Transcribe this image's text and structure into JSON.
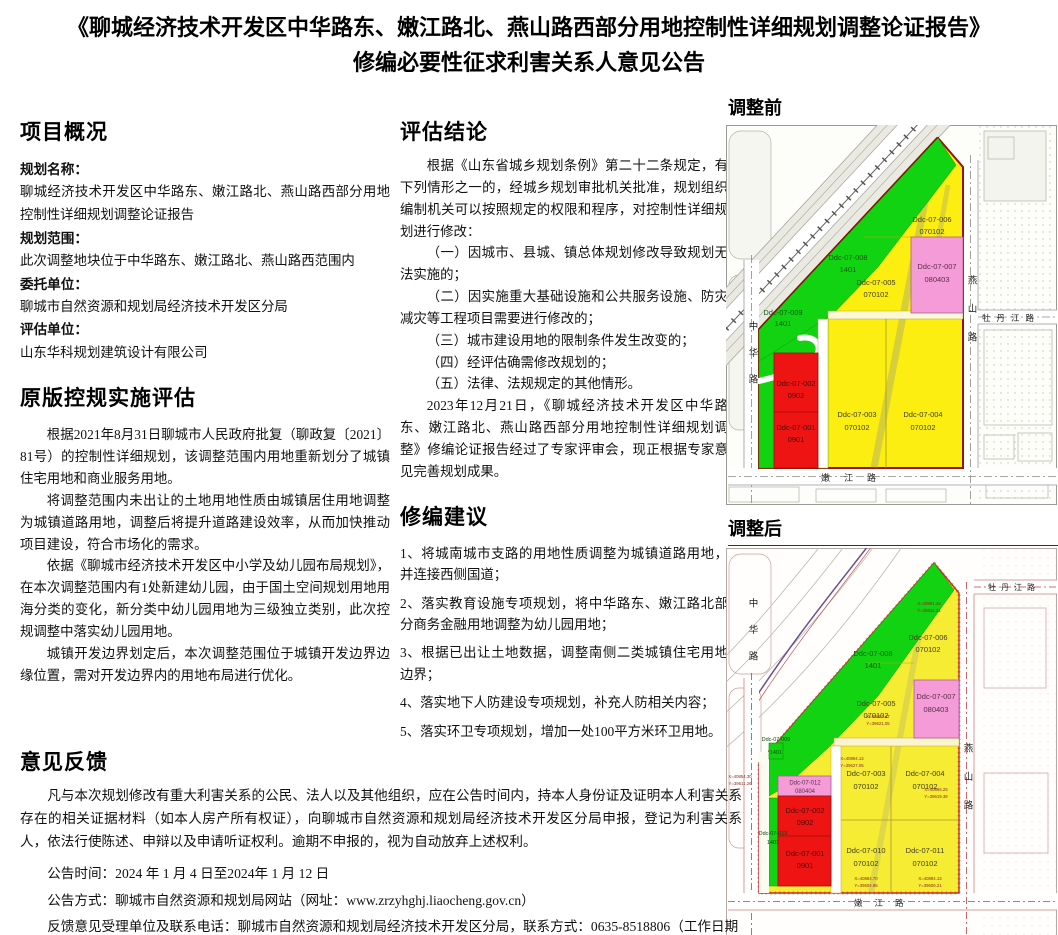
{
  "title": {
    "line1": "《聊城经济技术开发区中华路东、嫩江路北、燕山路西部分用地控制性详细规划调整论证报告》",
    "line2": "修编必要性征求利害关系人意见公告"
  },
  "project_overview": {
    "heading": "项目概况",
    "fields": [
      {
        "label": "规划名称：",
        "value": "聊城经济技术开发区中华路东、嫩江路北、燕山路西部分用地控制性详细规划调整论证报告"
      },
      {
        "label": "规划范围：",
        "value": "此次调整地块位于中华路东、嫩江路北、燕山路西范围内"
      },
      {
        "label": "委托单位：",
        "value": "聊城市自然资源和规划局经济技术开发区分局"
      },
      {
        "label": "评估单位：",
        "value": "山东华科规划建筑设计有限公司"
      }
    ]
  },
  "original_assessment": {
    "heading": "原版控规实施评估",
    "paragraphs": [
      "根据2021年8月31日聊城市人民政府批复（聊政复〔2021〕81号）的控制性详细规划，该调整范围内用地重新划分了城镇住宅用地和商业服务用地。",
      "将调整范围内未出让的土地用地性质由城镇居住用地调整为城镇道路用地，调整后将提升道路建设效率，从而加快推动项目建设，符合市场化的需求。",
      "依据《聊城市经济技术开发区中小学及幼儿园布局规划》，在本次调整范围内有1处新建幼儿园，由于国土空间规划用地用海分类的变化，新分类中幼儿园用地为三级独立类别，此次控规调整中落实幼儿园用地。",
      "城镇开发边界划定后，本次调整范围位于城镇开发边界边缘位置，需对开发边界内的用地布局进行优化。"
    ]
  },
  "conclusion": {
    "heading": "评估结论",
    "paragraphs": [
      "根据《山东省城乡规划条例》第二十二条规定，有下列情形之一的，经城乡规划审批机关批准，规划组织编制机关可以按照规定的权限和程序，对控制性详细规划进行修改：",
      "（一）因城市、县城、镇总体规划修改导致规划无法实施的；",
      "（二）因实施重大基础设施和公共服务设施、防灾减灾等工程项目需要进行修改的；",
      "（三）城市建设用地的限制条件发生改变的；",
      "（四）经评估确需修改规划的；",
      "（五）法律、法规规定的其他情形。",
      "2023年12月21日，《聊城经济技术开发区中华路东、嫩江路北、燕山路西部分用地控制性详细规划调整》修编论证报告经过了专家评审会，现正根据专家意见完善规划成果。"
    ]
  },
  "suggestions": {
    "heading": "修编建议",
    "items": [
      "1、将城南城市支路的用地性质调整为城镇道路用地，并连接西侧国道；",
      "2、落实教育设施专项规划，将中华路东、嫩江路北部分商务金融用地调整为幼儿园用地；",
      "3、根据已出让土地数据，调整南侧二类城镇住宅用地边界；",
      "4、落实地下人防建设专项规划，补充人防相关内容；",
      "5、落实环卫专项规划，增加一处100平方米环卫用地。"
    ]
  },
  "feedback": {
    "heading": "意见反馈",
    "paragraph": "凡与本次规划修改有重大利害关系的公民、法人以及其他组织，应在公告时间内，持本人身份证及证明本人利害关系存在的相关证据材料（如本人房产所有权证），向聊城市自然资源和规划局经济技术开发区分局申报，登记为利害关系人，依法行使陈述、申辩以及申请听证权利。逾期不申报的，视为自动放弃上述权利。",
    "lines": [
      "公告时间：2024 年  1  月  4  日至2024年  1  月  12  日",
      "公告方式：聊城市自然资源和规划局网站（网址：www.zrzyhghj.liaocheng.gov.cn）",
      "反馈意见受理单位及联系电话：聊城市自然资源和规划局经济技术开发区分局，联系方式：0635-8518806（工作日期间）"
    ]
  },
  "maps": {
    "roads": {
      "zhonghua": "中华路",
      "mudanjiang": "牡丹江路",
      "yanshan": "燕山路",
      "nenjiang": "嫩江路"
    },
    "legend_colors": {
      "residential_yellow": "#f6ec2a",
      "park_green": "#12d312",
      "commercial_red": "#ee1414",
      "business_pink": "#f49bd8"
    },
    "before": {
      "label": "调整前",
      "parcels": [
        {
          "code": "Ddc-07-006",
          "use": "070102"
        },
        {
          "code": "Ddc-07-008",
          "use": "1401"
        },
        {
          "code": "Ddc-07-005",
          "use": "070102"
        },
        {
          "code": "Ddc-07-007",
          "use": "080403"
        },
        {
          "code": "Ddc-07-009",
          "use": "1401"
        },
        {
          "code": "Ddc-07-002",
          "use": "0902"
        },
        {
          "code": "Ddc-07-001",
          "use": "0901"
        },
        {
          "code": "Ddc-07-003",
          "use": "070102"
        },
        {
          "code": "Ddc-07-004",
          "use": "070102"
        }
      ]
    },
    "after": {
      "label": "调整后",
      "parcels": [
        {
          "code": "Ddc-07-006",
          "use": "070102"
        },
        {
          "code": "Ddc-07-008",
          "use": "1401"
        },
        {
          "code": "Ddc-07-005",
          "use": "070102"
        },
        {
          "code": "Ddc-07-007",
          "use": "080403"
        },
        {
          "code": "Ddc-07-009",
          "use": "1401"
        },
        {
          "code": "Ddc-07-012",
          "use": "080404"
        },
        {
          "code": "Ddc-07-002",
          "use": "0902"
        },
        {
          "code": "Ddc-07-001",
          "use": "0901"
        },
        {
          "code": "Ddc-07-013",
          "use": "1401"
        },
        {
          "code": "Ddc-07-003",
          "use": "070102"
        },
        {
          "code": "Ddc-07-004",
          "use": "070102"
        },
        {
          "code": "Ddc-07-010",
          "use": "070102"
        },
        {
          "code": "Ddc-07-011",
          "use": "070102"
        }
      ],
      "coords": [
        "X=40891.45",
        "Y=39624.31",
        "X=40887.47",
        "Y=39621.05",
        "X=40894.13",
        "Y=39627.05",
        "X=40865.25",
        "Y=39619.38",
        "X=40884.70",
        "Y=39604.85",
        "X=40894.13",
        "Y=39606.21",
        "X=40854.30",
        "Y=39611.26"
      ]
    }
  }
}
